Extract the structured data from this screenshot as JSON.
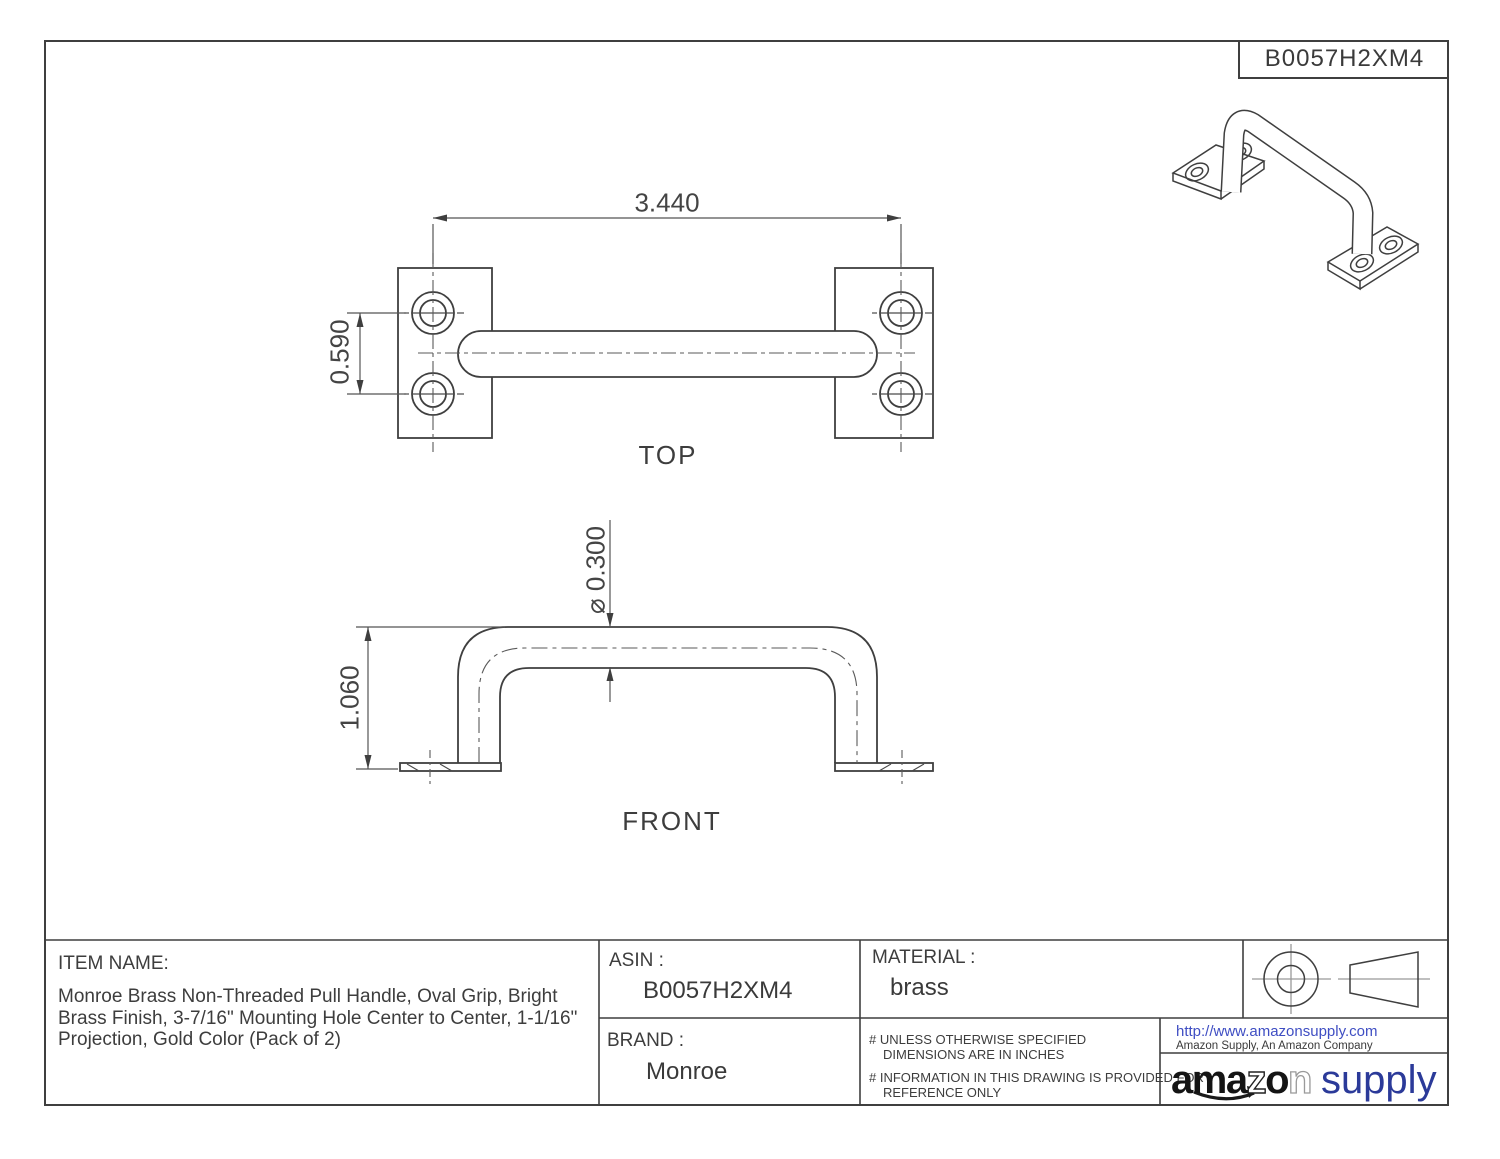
{
  "doc": {
    "code_box": "B0057H2XM4"
  },
  "views": {
    "top": {
      "label": "TOP",
      "dim_span": "3.440",
      "dim_hole_spacing": "0.590"
    },
    "front": {
      "label": "FRONT",
      "dim_height": "1.060",
      "dim_diameter": "⌀ 0.300"
    }
  },
  "title_block": {
    "item_name_label": "ITEM NAME:",
    "item_name": "Monroe Brass Non-Threaded Pull Handle, Oval Grip, Bright Brass Finish, 3-7/16\" Mounting Hole Center to Center, 1-1/16\" Projection, Gold Color (Pack of 2)",
    "asin_label": "ASIN :",
    "asin": "B0057H2XM4",
    "brand_label": "BRAND :",
    "brand": "Monroe",
    "material_label": "MATERIAL :",
    "material": "brass",
    "note1_line1": "# UNLESS OTHERWISE SPECIFIED",
    "note1_line2": "DIMENSIONS ARE IN INCHES",
    "note2_line1": "# INFORMATION IN THIS DRAWING IS PROVIDED FOR",
    "note2_line2": "REFERENCE ONLY",
    "url": "http://www.amazonsupply.com",
    "company": "Amazon Supply, An Amazon Company",
    "logo": {
      "part_ama": "ama",
      "part_z": "z",
      "part_o": "o",
      "part_n": "n",
      "part_supply": "supply"
    }
  },
  "colors": {
    "line": "#3f3f3f",
    "centerline": "#5a5a5a",
    "url_blue": "#3f4ec3",
    "supply_blue": "#2b3a99",
    "logo_black": "#141414"
  }
}
